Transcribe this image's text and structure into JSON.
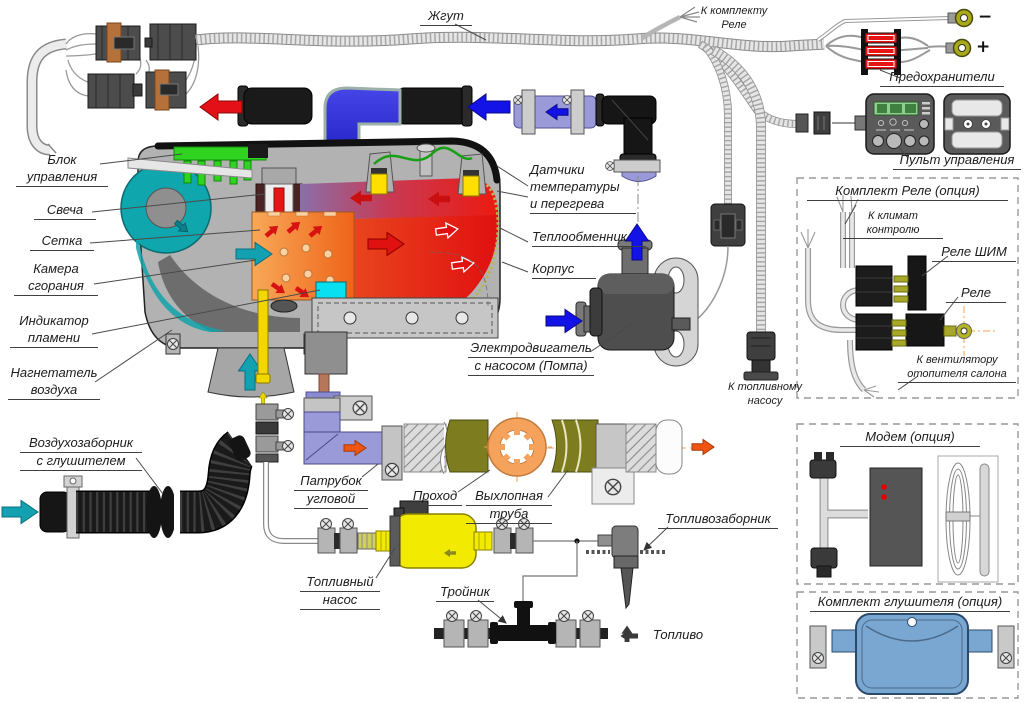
{
  "diagram": {
    "labels": {
      "harness": "Жгут",
      "to_relay_kit": [
        "К комплекту",
        "Реле"
      ],
      "fuses": "Предохранители",
      "control_panel": "Пульт управления",
      "control_unit": [
        "Блок",
        "управления"
      ],
      "glow_plug": "Свеча",
      "mesh": "Сетка",
      "combustion_chamber": [
        "Камера",
        "сгорания"
      ],
      "flame_indicator": [
        "Индикатор",
        "пламени"
      ],
      "air_blower": [
        "Нагнетатель",
        "воздуха"
      ],
      "air_intake": [
        "Воздухозаборник",
        "с глушителем"
      ],
      "sensors": [
        "Датчики",
        "температуры",
        "и перегрева"
      ],
      "heat_exchanger": "Теплообменник",
      "housing": "Корпус",
      "motor_pump": [
        "Электродвигатель",
        "с насосом (Помпа)"
      ],
      "to_fuel_pump": [
        "К топливному",
        "насосу"
      ],
      "elbow_pipe": [
        "Патрубок",
        "угловой"
      ],
      "passage": "Проход",
      "exhaust_pipe": [
        "Выхлопная",
        "труба"
      ],
      "fuel_pump": [
        "Топливный",
        "насос"
      ],
      "tee": "Тройник",
      "fuel": "Топливо",
      "fuel_pickup": "Топливозаборник",
      "minus": "−",
      "plus": "+"
    },
    "option_kits": {
      "relay_kit": {
        "title": "Комплект Реле (опция)",
        "to_climate": [
          "К климат",
          "контролю"
        ],
        "pwm_relay": "Реле ШИМ",
        "relay": "Реле",
        "to_fan": [
          "К вентилятору",
          "отопителя салона"
        ]
      },
      "modem": {
        "title": "Модем (опция)"
      },
      "muffler_kit": {
        "title": "Комплект глушителя (опция)"
      }
    },
    "colors": {
      "coolant_cold": "#1313e8",
      "coolant_hot": "#e81515",
      "combustion_orange": "#f07020",
      "air_teal": "#13a0b0",
      "fuel_yellow": "#f2e000",
      "exhaust_orange": "#ef5510",
      "pcb_green": "#2fd320",
      "hose_purple": "#9a9ad8",
      "muffler_blue": "#7aa7d2",
      "fuse_red": "#e81414",
      "wire_green": "#17a017"
    }
  }
}
